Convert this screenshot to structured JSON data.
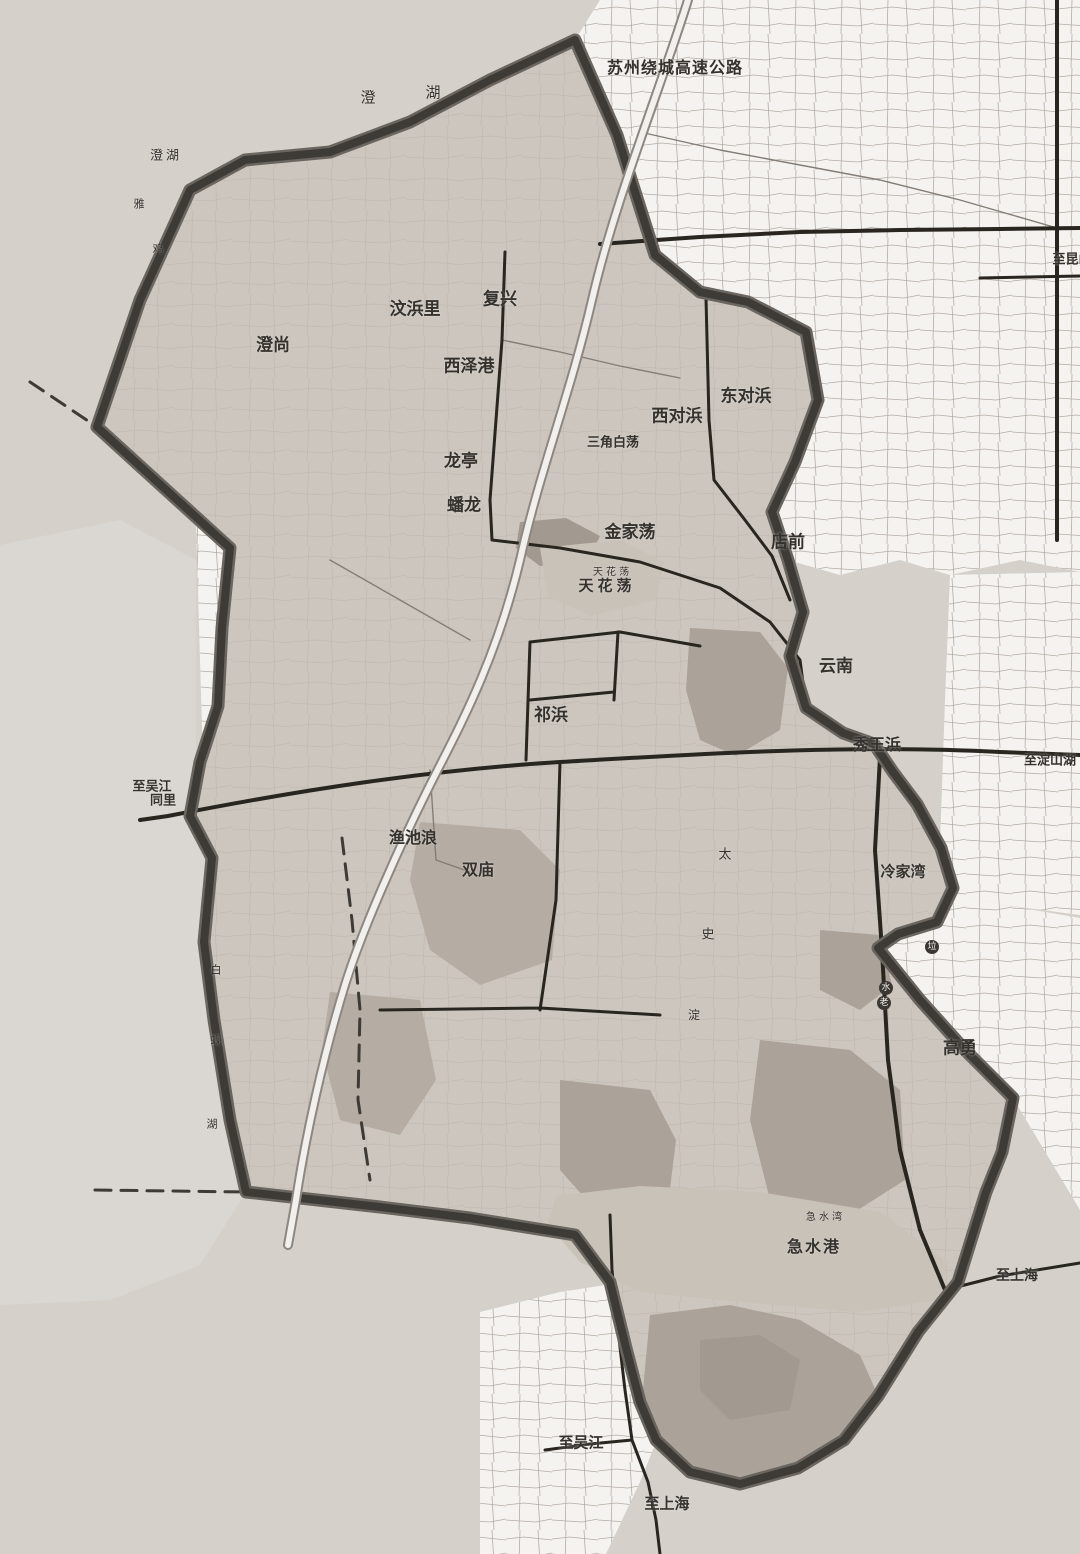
{
  "map": {
    "colors": {
      "base": "#d5d0ca",
      "outside_light": "#dad6d1",
      "parcel_white": "#f5f3f0",
      "parcel_line": "#b3aca4",
      "interior": "#ccc6be",
      "built_patch": "#aba299",
      "water": "#c9c2b9",
      "boundary": "#3e3a36",
      "boundary_outer": "#6b655f",
      "road": "#29251f",
      "expressway_fill": "#f2f0ed",
      "expressway_casing": "#8d8780",
      "label": "#35312d",
      "marker_bg": "#3b3733",
      "marker_text": "#f1efec"
    },
    "labels": [
      {
        "id": "expressway-name",
        "text": "苏州绕城高速公路",
        "x": 675,
        "y": 68,
        "size": 16,
        "bold": true,
        "spacing": 1
      },
      {
        "id": "lake-chenghu-char-1",
        "text": "澄",
        "x": 368,
        "y": 98,
        "size": 15
      },
      {
        "id": "lake-chenghu-char-2",
        "text": "湖",
        "x": 433,
        "y": 93,
        "size": 15
      },
      {
        "id": "lake-chenghu-small",
        "text": "澄湖",
        "x": 166,
        "y": 156,
        "size": 13,
        "spacing": 3
      },
      {
        "id": "faint-char-1",
        "text": "雅",
        "x": 139,
        "y": 204,
        "size": 11
      },
      {
        "id": "faint-char-2",
        "text": "鸡",
        "x": 158,
        "y": 249,
        "size": 11
      },
      {
        "id": "village-wenbangli",
        "text": "汶浜里",
        "x": 415,
        "y": 310,
        "size": 17,
        "bold": true
      },
      {
        "id": "village-fuxing",
        "text": "复兴",
        "x": 500,
        "y": 300,
        "size": 17,
        "bold": true
      },
      {
        "id": "village-chengshang",
        "text": "澄尚",
        "x": 273,
        "y": 346,
        "size": 17,
        "bold": true
      },
      {
        "id": "village-xizegang",
        "text": "西泽港",
        "x": 469,
        "y": 367,
        "size": 17,
        "bold": true
      },
      {
        "id": "village-dongduibang",
        "text": "东对浜",
        "x": 746,
        "y": 397,
        "size": 17,
        "bold": true
      },
      {
        "id": "village-xiduibang",
        "text": "西对浜",
        "x": 677,
        "y": 417,
        "size": 17,
        "bold": true
      },
      {
        "id": "lake-sanjiaobaidang",
        "text": "三角白荡",
        "x": 613,
        "y": 443,
        "size": 13,
        "bold": true
      },
      {
        "id": "village-longting",
        "text": "龙亭",
        "x": 461,
        "y": 462,
        "size": 17,
        "bold": true
      },
      {
        "id": "village-panlong",
        "text": "蟠龙",
        "x": 464,
        "y": 506,
        "size": 17,
        "bold": true
      },
      {
        "id": "lake-jinjiadang",
        "text": "金家荡",
        "x": 630,
        "y": 533,
        "size": 17,
        "bold": true
      },
      {
        "id": "village-dianqian",
        "text": "店前",
        "x": 788,
        "y": 543,
        "size": 17,
        "bold": true
      },
      {
        "id": "lake-tianhuadang-small",
        "text": "天 花 荡",
        "x": 611,
        "y": 573,
        "size": 10
      },
      {
        "id": "lake-tianhuadang",
        "text": "天花荡",
        "x": 607,
        "y": 586,
        "size": 15,
        "bold": true,
        "spacing": 4
      },
      {
        "id": "village-yunnan",
        "text": "云南",
        "x": 836,
        "y": 667,
        "size": 17,
        "bold": true
      },
      {
        "id": "village-qibang",
        "text": "祁浜",
        "x": 551,
        "y": 716,
        "size": 17,
        "bold": true
      },
      {
        "id": "village-xiuwangbang",
        "text": "秀王浜",
        "x": 877,
        "y": 745,
        "size": 16,
        "bold": true
      },
      {
        "id": "dir-dianshanhu",
        "text": "至淀山湖",
        "x": 1050,
        "y": 761,
        "size": 13,
        "bold": true
      },
      {
        "id": "dir-wujiang-line1",
        "text": "至吴江",
        "x": 152,
        "y": 787,
        "size": 13,
        "bold": true
      },
      {
        "id": "dir-tongli-line2",
        "text": "同里",
        "x": 163,
        "y": 801,
        "size": 13,
        "bold": true
      },
      {
        "id": "village-yuchilang",
        "text": "渔池浪",
        "x": 413,
        "y": 838,
        "size": 16,
        "bold": true
      },
      {
        "id": "village-shuangmiao",
        "text": "双庙",
        "x": 478,
        "y": 870,
        "size": 16,
        "bold": true
      },
      {
        "id": "village-lengjiawan",
        "text": "冷家湾",
        "x": 903,
        "y": 872,
        "size": 15,
        "bold": true
      },
      {
        "id": "lake-taishidian-char-1",
        "text": "太",
        "x": 725,
        "y": 855,
        "size": 13
      },
      {
        "id": "lake-taishidian-char-2",
        "text": "史",
        "x": 708,
        "y": 935,
        "size": 13
      },
      {
        "id": "lake-taishidian-char-3",
        "text": "淀",
        "x": 694,
        "y": 1015,
        "size": 12
      },
      {
        "id": "lake-baixianhu-char-1",
        "text": "白",
        "x": 216,
        "y": 970,
        "size": 11
      },
      {
        "id": "lake-baixianhu-char-2",
        "text": "蚬",
        "x": 216,
        "y": 1040,
        "size": 11
      },
      {
        "id": "lake-baixianhu-char-3",
        "text": "湖",
        "x": 212,
        "y": 1124,
        "size": 11
      },
      {
        "id": "marker-la",
        "text": "垃",
        "x": 932,
        "y": 947,
        "size": 9,
        "circled": true
      },
      {
        "id": "marker-shui",
        "text": "水",
        "x": 886,
        "y": 988,
        "size": 9,
        "circled": true
      },
      {
        "id": "marker-lao",
        "text": "老",
        "x": 884,
        "y": 1003,
        "size": 9,
        "circled": true
      },
      {
        "id": "village-gaoyong",
        "text": "高勇",
        "x": 960,
        "y": 1049,
        "size": 17,
        "bold": true
      },
      {
        "id": "bay-jishui-small",
        "text": "急 水 湾",
        "x": 824,
        "y": 1218,
        "size": 10
      },
      {
        "id": "river-jishuigang",
        "text": "急水港",
        "x": 814,
        "y": 1247,
        "size": 16,
        "bold": true,
        "spacing": 2
      },
      {
        "id": "dir-shanghai-east",
        "text": "至上海",
        "x": 1017,
        "y": 1276,
        "size": 14,
        "bold": true
      },
      {
        "id": "dir-wujiang-south",
        "text": "至吴江",
        "x": 581,
        "y": 1443,
        "size": 15,
        "bold": true
      },
      {
        "id": "dir-shanghai-south",
        "text": "至上海",
        "x": 667,
        "y": 1504,
        "size": 15,
        "bold": true
      },
      {
        "id": "dir-kunshan",
        "text": "至昆山",
        "x": 1072,
        "y": 260,
        "size": 13,
        "bold": true
      }
    ]
  }
}
